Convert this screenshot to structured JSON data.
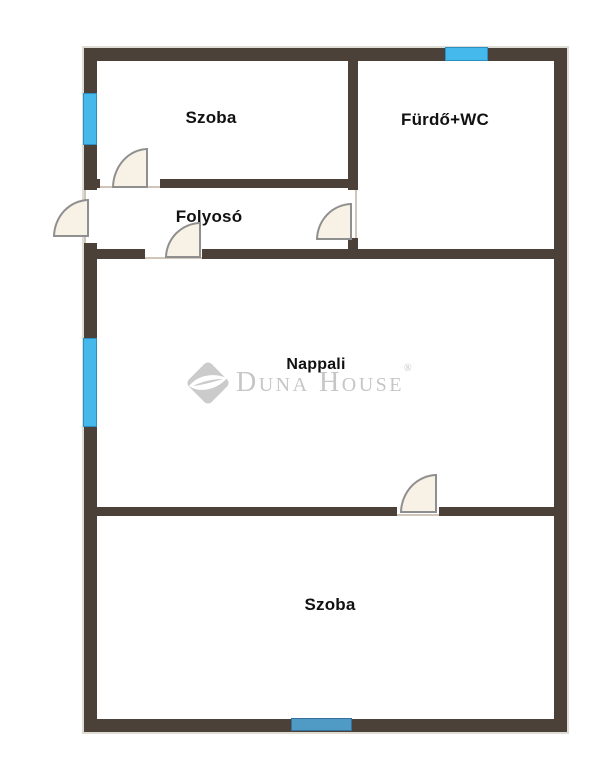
{
  "floorplan": {
    "rooms": [
      {
        "name": "szoba-top",
        "label": "Szoba"
      },
      {
        "name": "furdo-wc",
        "label": "Fürdő+WC"
      },
      {
        "name": "folyoso",
        "label": "Folyosó"
      },
      {
        "name": "nappali",
        "label": "Nappali"
      },
      {
        "name": "szoba-bottom",
        "label": "Szoba"
      }
    ],
    "watermark": {
      "brand": "Duna House",
      "registered_mark": "®"
    },
    "colors": {
      "wall": "#4c4138",
      "window_bright_blue": "#45b8ec",
      "window_steel_blue": "#4f9bc6",
      "door_leaf_fill": "#f8f1e5",
      "door_stroke": "#8f8f8f",
      "watermark_gray": "#c6c6c6",
      "room_label": "#111111",
      "background": "#ffffff"
    }
  }
}
